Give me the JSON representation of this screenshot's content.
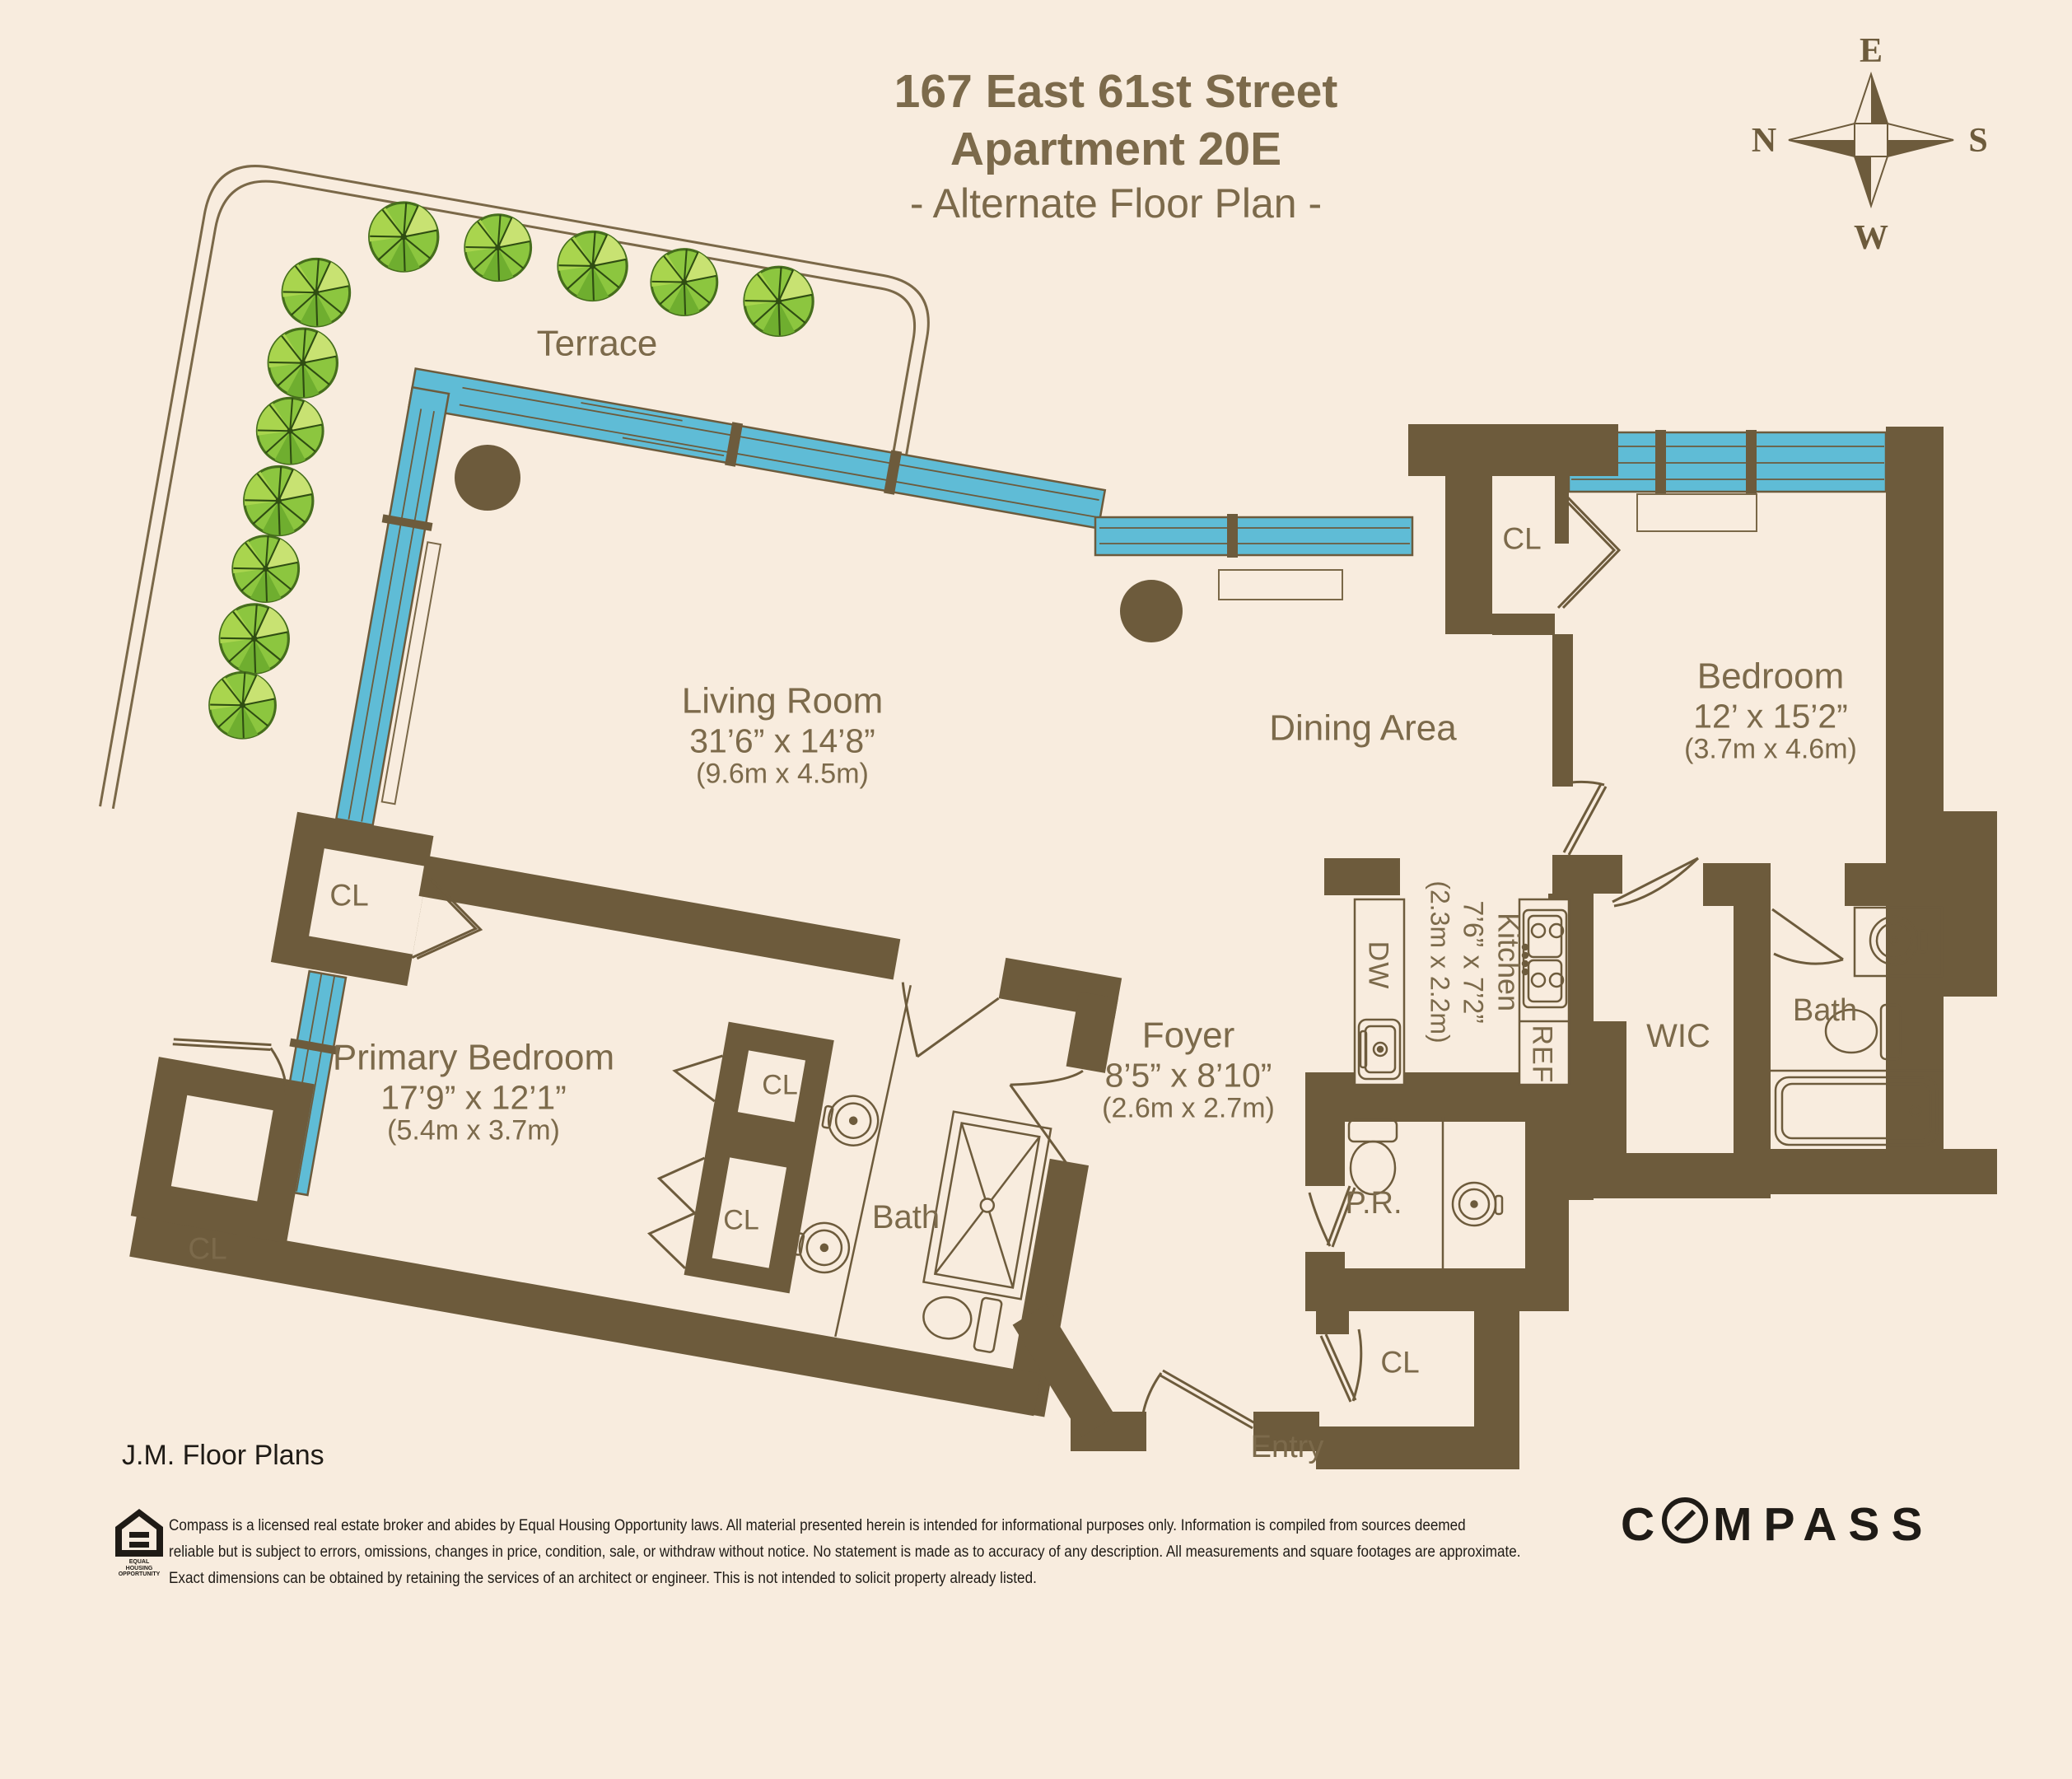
{
  "title": {
    "line1": "167 East 61st Street",
    "line2": "Apartment 20E",
    "line3": "- Alternate Floor Plan -"
  },
  "compass_rose": {
    "north": "N",
    "south": "S",
    "east": "E",
    "west": "W"
  },
  "rooms": {
    "terrace": {
      "label": "Terrace"
    },
    "living_room": {
      "label": "Living Room",
      "dimensions": "31’6” x 14’8”",
      "metric": "(9.6m x 4.5m)"
    },
    "dining_area": {
      "label": "Dining Area"
    },
    "bedroom": {
      "label": "Bedroom",
      "dimensions": "12’ x 15’2”",
      "metric": "(3.7m x 4.6m)"
    },
    "primary_bedroom": {
      "label": "Primary Bedroom",
      "dimensions": "17’9” x 12’1”",
      "metric": "(5.4m x 3.7m)"
    },
    "foyer": {
      "label": "Foyer",
      "dimensions": "8’5” x 8’10”",
      "metric": "(2.6m x 2.7m)"
    },
    "kitchen": {
      "label": "Kitchen",
      "dimensions": "7’6” x 7’2”",
      "metric": "(2.3m x 2.2m)"
    },
    "wic": {
      "label": "WIC"
    },
    "bath": {
      "label": "Bath"
    },
    "primary_bath": {
      "label": "Bath"
    },
    "powder_room": {
      "label": "P.R."
    },
    "entry": {
      "label": "Entry"
    },
    "closet": {
      "label": "CL"
    },
    "dishwasher": {
      "label": "DW"
    },
    "refrigerator": {
      "label": "REF"
    }
  },
  "footer": {
    "credit": "J.M. Floor Plans",
    "equal_housing_line1": "EQUAL HOUSING",
    "equal_housing_line2": "OPPORTUNITY",
    "disclaimer_line1": "Compass is a licensed real estate broker and abides by Equal Housing Opportunity laws. All material presented herein is intended for informational purposes only. Information is compiled from sources deemed",
    "disclaimer_line2": "reliable but is subject to errors, omissions, changes in price, condition, sale, or withdraw without notice. No statement is made as to accuracy of any description. All measurements and square footages are approximate.",
    "disclaimer_line3": "Exact dimensions can be obtained by retaining the services of an architect or engineer. This is not intended to solicit property already listed.",
    "brand": "COMPASS"
  },
  "colors": {
    "background": "#f8ecde",
    "wall": "#6d5b3c",
    "window_glass": "#5fbcd6",
    "label_text": "#7c6a4b",
    "footer_text": "#1f1b16",
    "tree_green": "#8cc63f"
  }
}
